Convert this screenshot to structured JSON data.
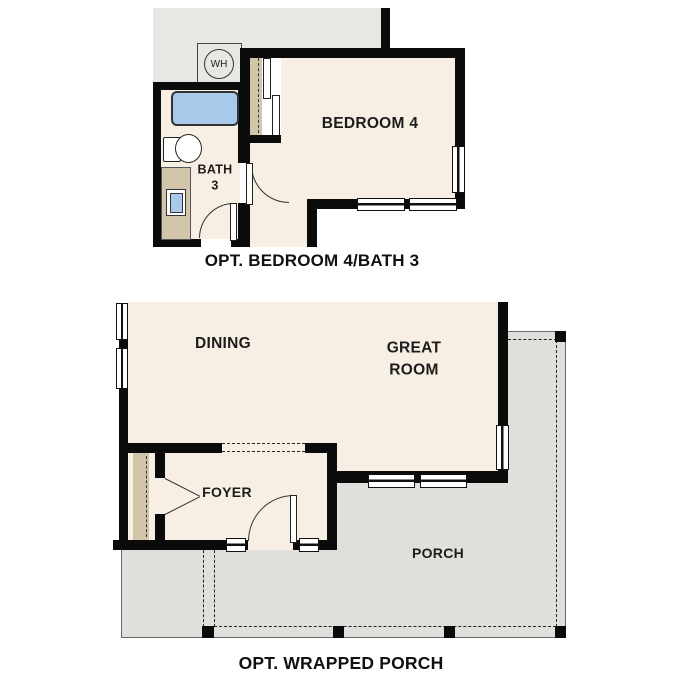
{
  "plan_top": {
    "caption": "OPT. BEDROOM 4/BATH 3",
    "rooms": {
      "bedroom": "BEDROOM 4",
      "bath": "BATH\n3"
    },
    "fixtures": {
      "water_heater": "WH"
    }
  },
  "plan_bottom": {
    "caption": "OPT. WRAPPED PORCH",
    "rooms": {
      "dining": "DINING",
      "great_room": "GREAT\nROOM",
      "foyer": "FOYER",
      "porch": "PORCH"
    }
  },
  "colors": {
    "wall": "#0b0b0b",
    "cream": "#f7efe3",
    "gray": "#e8e7e4",
    "porch": "#e0dfdc",
    "tan": "#d2c5aa",
    "blue": "#a9c9ea",
    "line": "#333333"
  }
}
